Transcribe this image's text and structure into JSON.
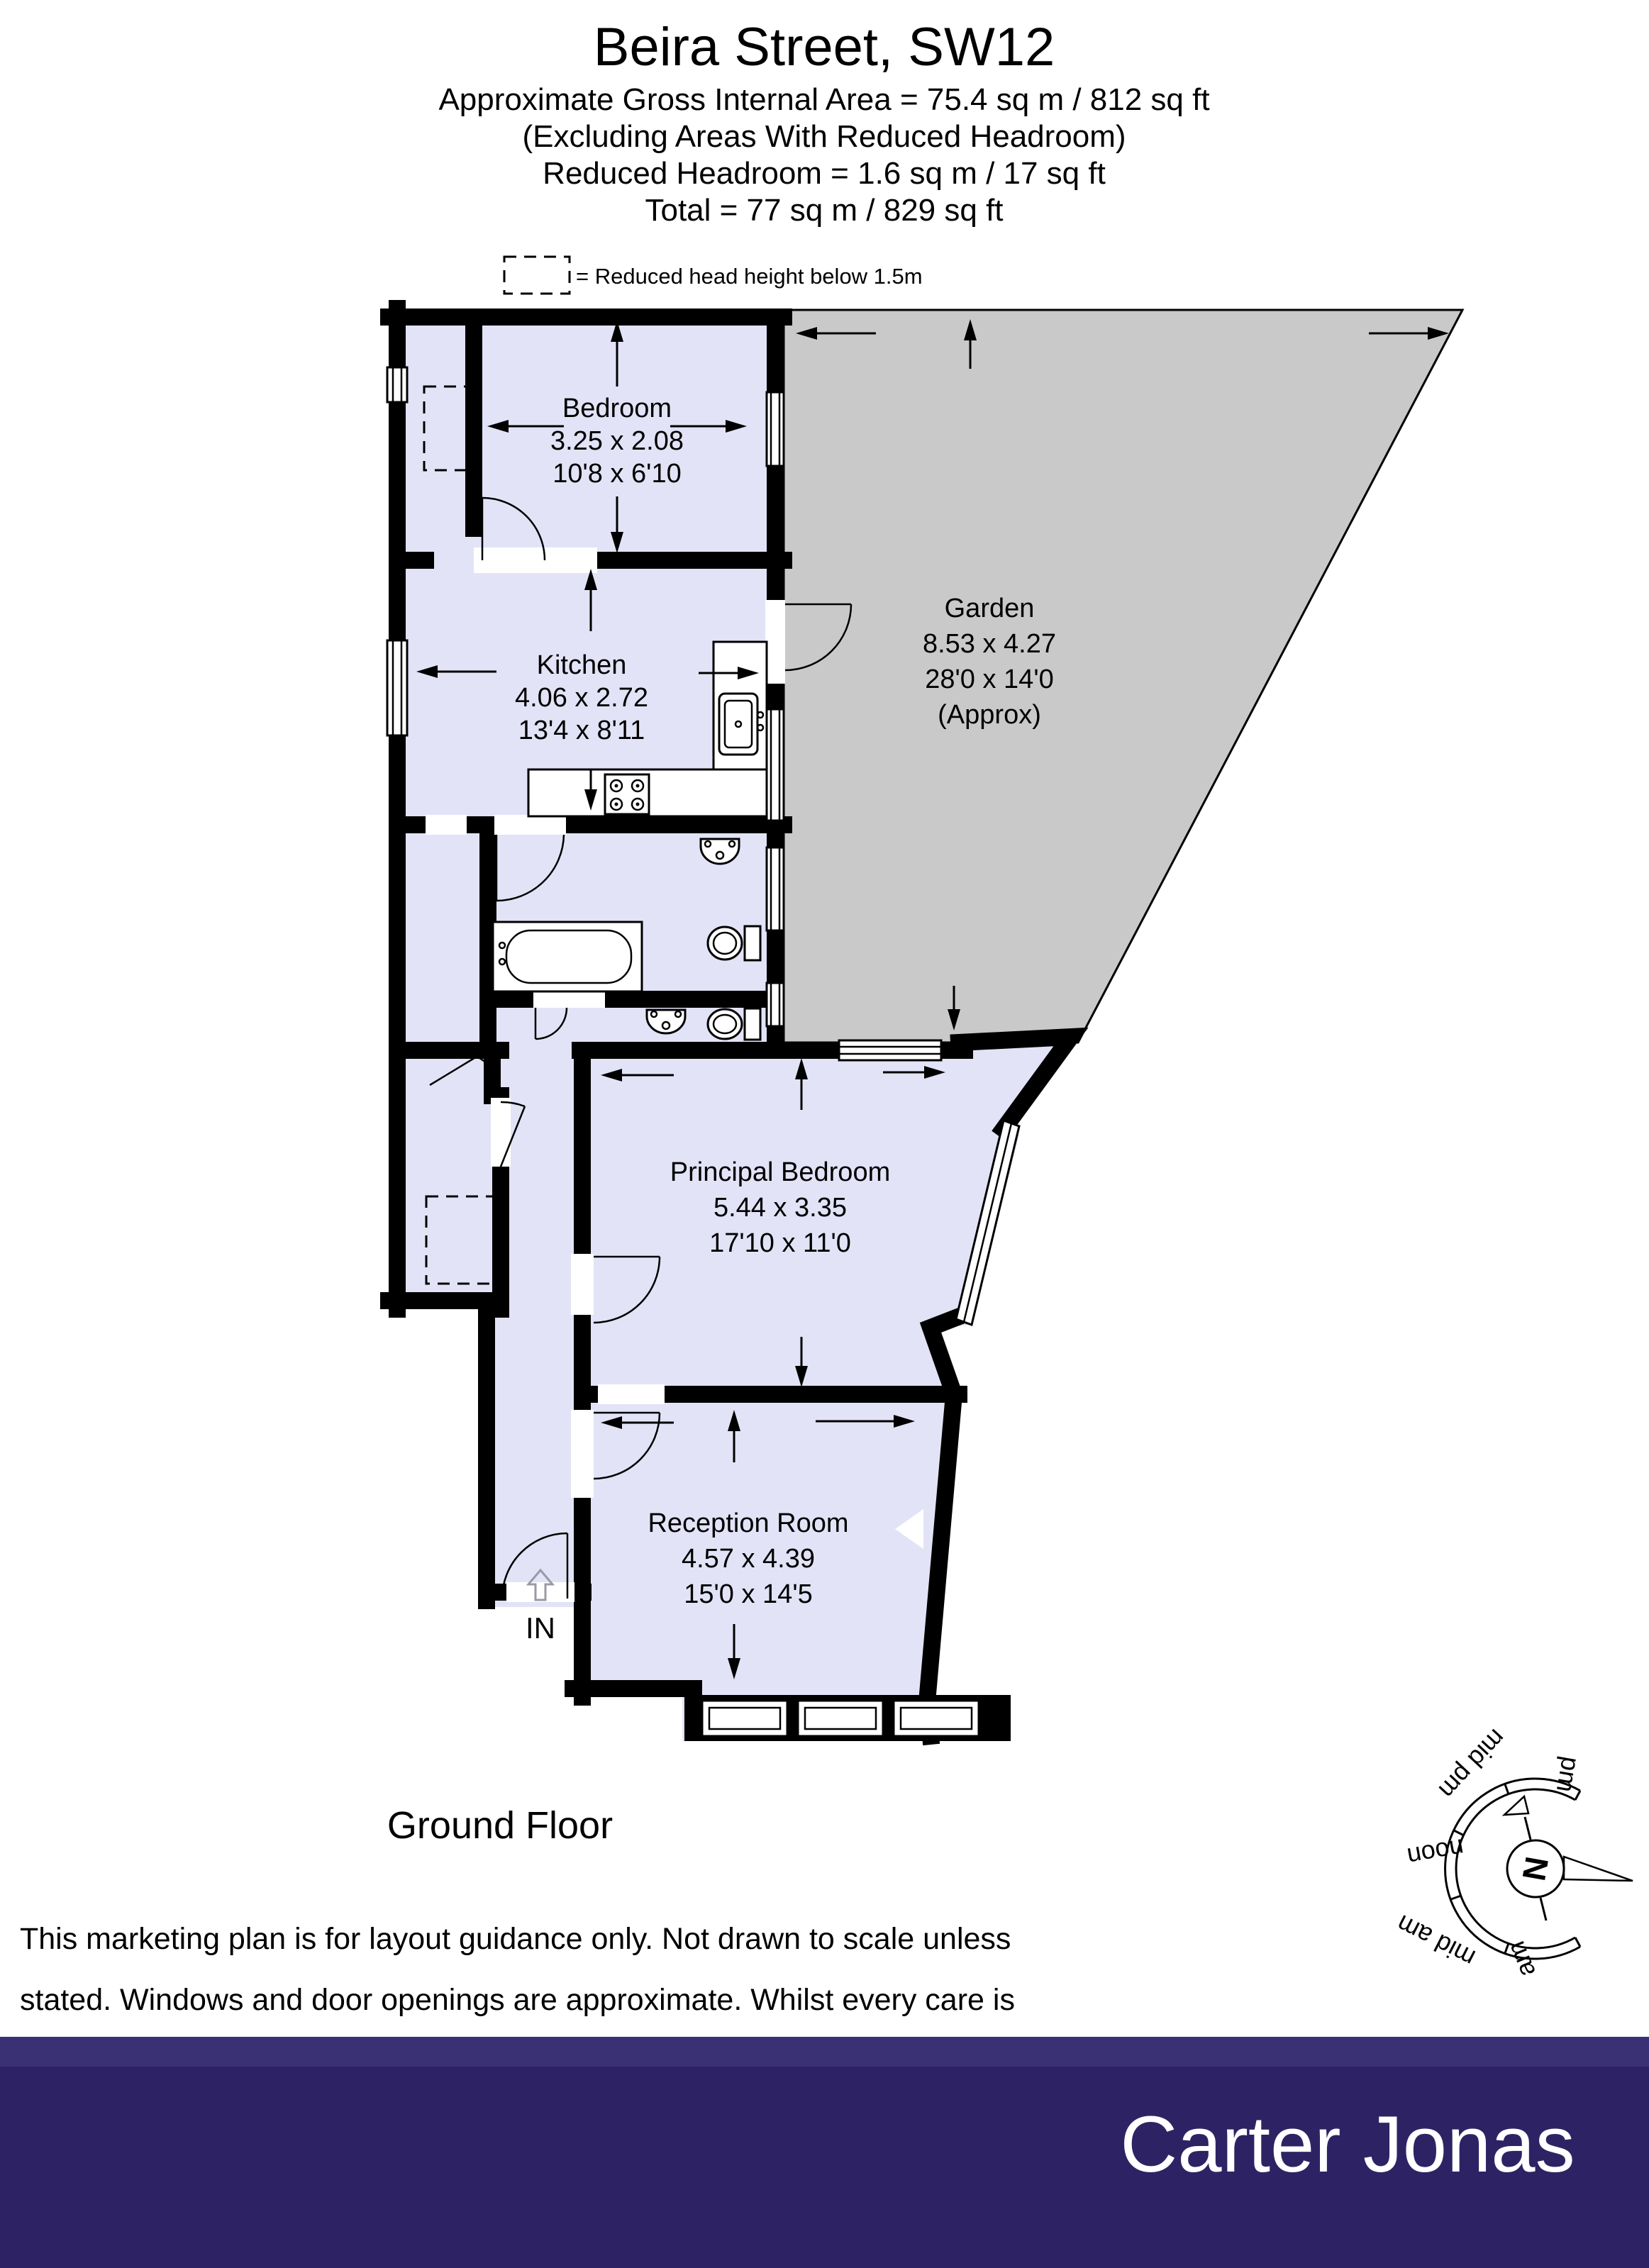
{
  "header": {
    "title": "Beira Street, SW12",
    "subtitle_lines": [
      "Approximate Gross Internal Area  = 75.4 sq m / 812 sq ft",
      "(Excluding Areas With Reduced Headroom)",
      "Reduced Headroom = 1.6 sq m / 17 sq ft",
      "Total = 77 sq m / 829 sq ft"
    ]
  },
  "legend": {
    "label": "= Reduced head height below 1.5m"
  },
  "rooms": {
    "bedroom": {
      "name": "Bedroom",
      "metric": "3.25 x 2.08",
      "imperial": "10'8 x 6'10"
    },
    "kitchen": {
      "name": "Kitchen",
      "metric": "4.06 x 2.72",
      "imperial": "13'4 x 8'11"
    },
    "garden": {
      "name": "Garden",
      "metric": "8.53 x 4.27",
      "imperial": "28'0 x 14'0",
      "note": "(Approx)"
    },
    "principal_bedroom": {
      "name": "Principal Bedroom",
      "metric": "5.44 x 3.35",
      "imperial": "17'10 x 11'0"
    },
    "reception_room": {
      "name": "Reception Room",
      "metric": "4.57 x 4.39",
      "imperial": "15'0 x 14'5"
    }
  },
  "entrance_label": "IN",
  "floor_label": "Ground Floor",
  "disclaimer_lines": [
    "This marketing plan is for layout guidance only. Not drawn to scale unless",
    "stated. Windows and door openings are approximate. Whilst every care is",
    "taken in the preparation of this plan, please check all dimensions, shapes",
    "and compass bearings before making any decisions reliant upon them."
  ],
  "compass": {
    "north_label": "N",
    "time_labels": [
      "pm",
      "mid pm",
      "noon",
      "mid am",
      "am"
    ]
  },
  "footer": {
    "brand": "Carter Jonas"
  },
  "colors": {
    "room_fill": "#E3E3F7",
    "garden_fill": "#C9C9C9",
    "wall": "#000000",
    "footer_bg": "#2D2364",
    "footer_bg_top": "#3A3174"
  }
}
